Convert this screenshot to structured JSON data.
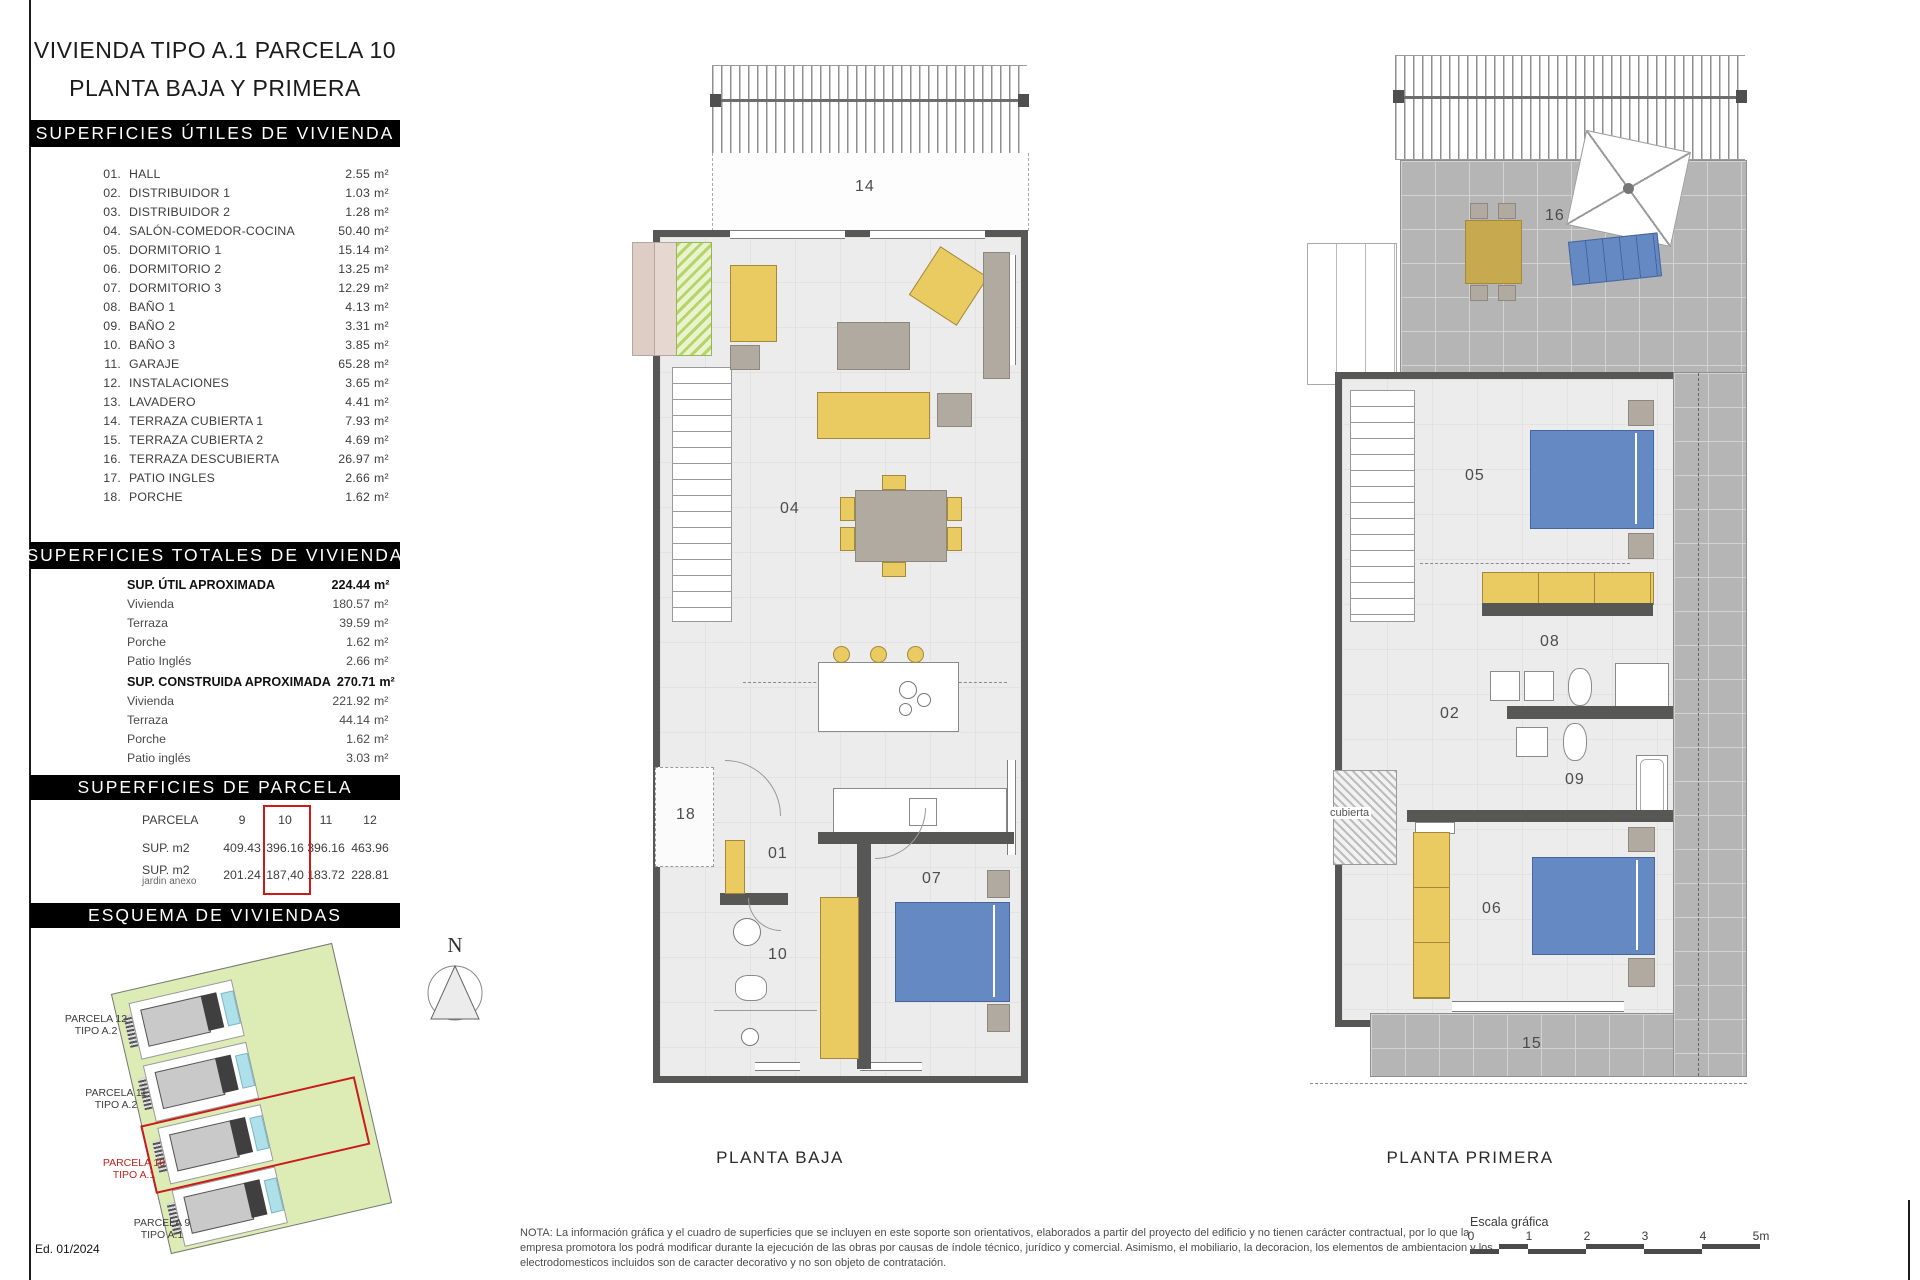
{
  "colors": {
    "wall": "#575756",
    "floor": "#ececec",
    "furniture_yellow": "#e9cb62",
    "bed_blue": "#6589c2",
    "furniture_gray": "#b0aaa0",
    "terrace_tile": "#b5b5b5",
    "site_green": "#dcecb4",
    "pool_blue": "#aee0ea",
    "highlight_red": "#cc1a1a",
    "header_bg": "#000000",
    "header_text": "#ffffff"
  },
  "panel": {
    "title_line1": "VIVIENDA TIPO A.1 PARCELA 10",
    "title_line2": "PLANTA BAJA Y PRIMERA",
    "utiles": {
      "header": "SUPERFICIES ÚTILES DE VIVIENDA",
      "unit": "m²",
      "rooms": [
        {
          "num": "01.",
          "label": "HALL",
          "value": "2.55"
        },
        {
          "num": "02.",
          "label": "DISTRIBUIDOR 1",
          "value": "1.03"
        },
        {
          "num": "03.",
          "label": "DISTRIBUIDOR 2",
          "value": "1.28"
        },
        {
          "num": "04.",
          "label": "SALÓN-COMEDOR-COCINA",
          "value": "50.40"
        },
        {
          "num": "05.",
          "label": "DORMITORIO 1",
          "value": "15.14"
        },
        {
          "num": "06.",
          "label": "DORMITORIO 2",
          "value": "13.25"
        },
        {
          "num": "07.",
          "label": "DORMITORIO 3",
          "value": "12.29"
        },
        {
          "num": "08.",
          "label": "BAÑO 1",
          "value": "4.13"
        },
        {
          "num": "09.",
          "label": "BAÑO 2",
          "value": "3.31"
        },
        {
          "num": "10.",
          "label": "BAÑO 3",
          "value": "3.85"
        },
        {
          "num": "11.",
          "label": "GARAJE",
          "value": "65.28"
        },
        {
          "num": "12.",
          "label": "INSTALACIONES",
          "value": "3.65"
        },
        {
          "num": "13.",
          "label": "LAVADERO",
          "value": "4.41"
        },
        {
          "num": "14.",
          "label": "TERRAZA CUBIERTA 1",
          "value": "7.93"
        },
        {
          "num": "15.",
          "label": "TERRAZA CUBIERTA 2",
          "value": "4.69"
        },
        {
          "num": "16.",
          "label": "TERRAZA DESCUBIERTA",
          "value": "26.97"
        },
        {
          "num": "17.",
          "label": "PATIO INGLES",
          "value": "2.66"
        },
        {
          "num": "18.",
          "label": "PORCHE",
          "value": "1.62"
        }
      ]
    },
    "totales": {
      "header": "SUPERFICIES TOTALES DE VIVIENDA",
      "unit": "m²",
      "groups": [
        {
          "label": "SUP. ÚTIL APROXIMADA",
          "value": "224.44",
          "rows": [
            {
              "label": "Vivienda",
              "value": "180.57"
            },
            {
              "label": "Terraza",
              "value": "39.59"
            },
            {
              "label": "Porche",
              "value": "1.62"
            },
            {
              "label": "Patio Inglés",
              "value": "2.66"
            }
          ]
        },
        {
          "label": "SUP. CONSTRUIDA APROXIMADA",
          "value": "270.71",
          "rows": [
            {
              "label": "Vivienda",
              "value": "221.92"
            },
            {
              "label": "Terraza",
              "value": "44.14"
            },
            {
              "label": "Porche",
              "value": "1.62"
            },
            {
              "label": "Patio inglés",
              "value": "3.03"
            }
          ]
        }
      ]
    },
    "parcela": {
      "header": "SUPERFICIES DE PARCELA",
      "row_label_parcela": "PARCELA",
      "row_label_sup": "SUP. m2",
      "row_label_jardin": "SUP. m2",
      "row_label_jardin_sub": "jardin anexo",
      "columns": [
        "9",
        "10",
        "11",
        "12"
      ],
      "sup_values": [
        "409.43",
        "396.16",
        "396.16",
        "463.96"
      ],
      "jardin_values": [
        "201.24",
        "187,40",
        "183.72",
        "228.81"
      ],
      "highlighted_column": "10"
    },
    "esquema": {
      "header": "ESQUEMA DE VIVIENDAS",
      "labels": [
        {
          "name": "PARCELA 12",
          "tipo": "TIPO A.2"
        },
        {
          "name": "PARCELA 11",
          "tipo": "TIPO A.2"
        },
        {
          "name": "PARCELA 10",
          "tipo": "TIPO A.1"
        },
        {
          "name": "PARCELA 9",
          "tipo": "TIPO A.1"
        }
      ]
    },
    "edition": "Ed. 01/2024"
  },
  "north": "N",
  "plans": {
    "baja": {
      "caption": "PLANTA BAJA",
      "labels": {
        "r14": "14",
        "r04": "04",
        "r18": "18",
        "r01": "01",
        "r10": "10",
        "r07": "07"
      }
    },
    "primera": {
      "caption": "PLANTA PRIMERA",
      "labels": {
        "r16": "16",
        "r05": "05",
        "r08": "08",
        "r02": "02",
        "r09": "09",
        "r06": "06",
        "r15": "15",
        "cubierta": "cubierta"
      }
    }
  },
  "footer": {
    "note_lines": [
      "NOTA: La información gráfica y el cuadro de superficies que se incluyen en este soporte son orientativos, elaborados a partir del proyecto del edificio y no tienen carácter contractual, por lo que la",
      "empresa promotora los podrá modificar durante la ejecución de las obras por causas de índole técnico, jurídico y comercial. Asimismo, el mobiliario, la decoracion, los elementos de ambientacion y los",
      "electrodomesticos incluidos son de caracter decorativo y no son objeto de contratación."
    ],
    "scale": {
      "label": "Escala gráfica",
      "ticks": [
        "0",
        "1",
        "2",
        "3",
        "4",
        "5m"
      ]
    }
  }
}
